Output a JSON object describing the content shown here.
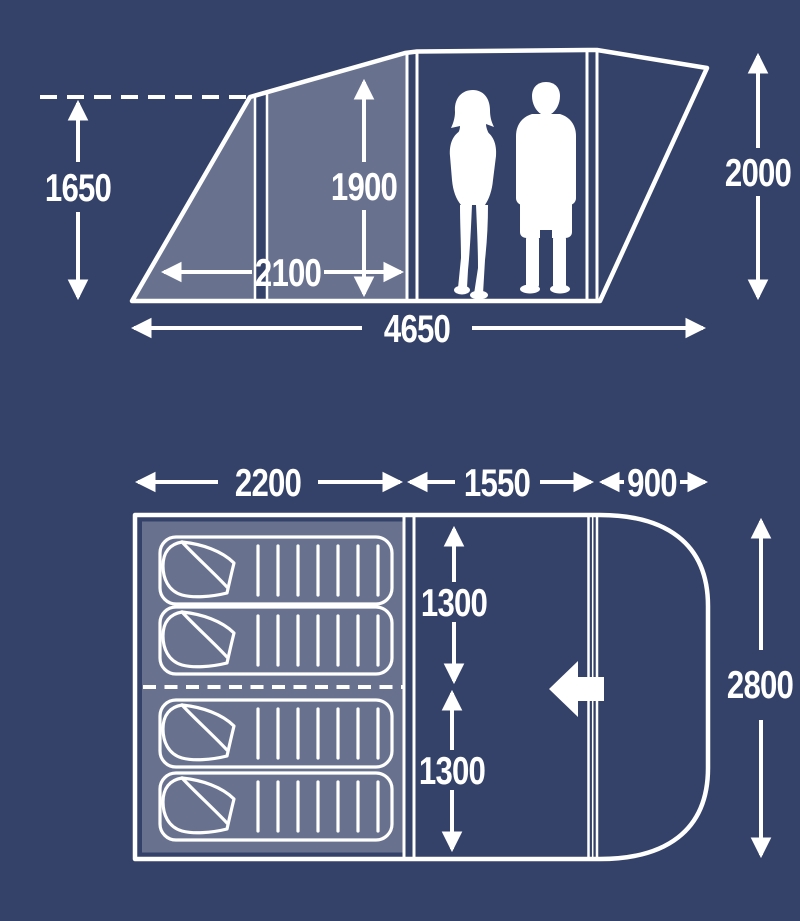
{
  "title": "tent-dimensions-diagram",
  "colors": {
    "background": "#344269",
    "line": "#ffffff",
    "panel_shade": "rgba(255,255,255,0.26)"
  },
  "icons": {
    "entrance_arrow": "left-block-arrow",
    "people": "two-person-scale-silhouettes"
  },
  "side_view": {
    "labels": {
      "height_front": "1650",
      "height_inner": "1900",
      "width_inner": "2100",
      "length_total": "4650",
      "height_rear": "2000"
    }
  },
  "floor_plan": {
    "bed_count": 4,
    "labels": {
      "length_bedroom": "2200",
      "length_living": "1550",
      "length_porch": "900",
      "width_half_top": "1300",
      "width_half_bottom": "1300",
      "width_total": "2800"
    }
  }
}
